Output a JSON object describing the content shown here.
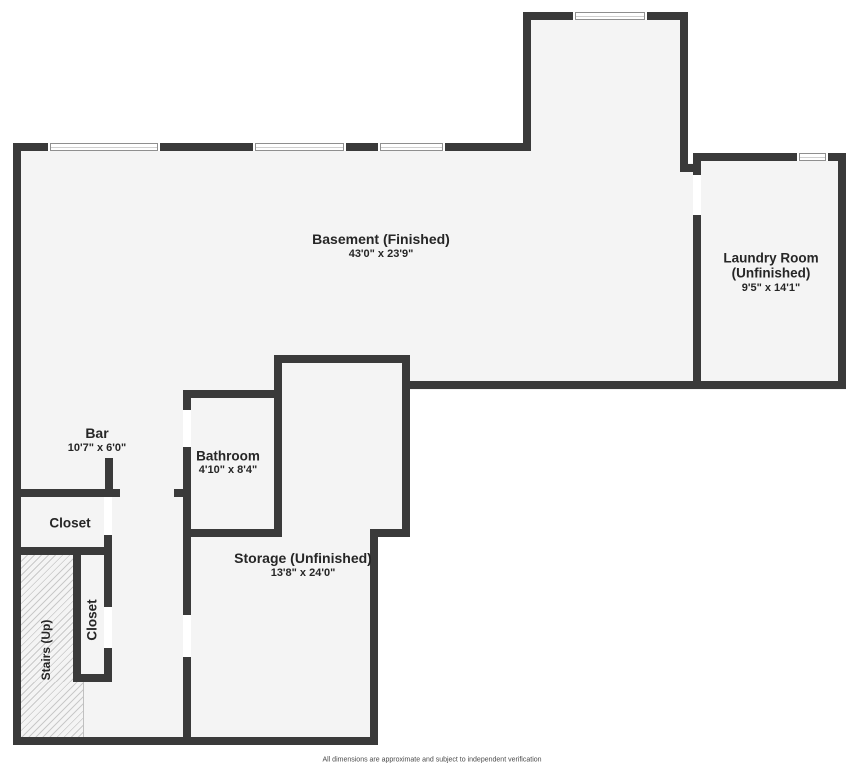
{
  "title": "Basement floor plan",
  "rooms": {
    "basement": {
      "name": "Basement (Finished)",
      "dims": "43'0\" x 23'9\""
    },
    "laundry": {
      "line1": "Laundry Room",
      "line2": "(Unfinished)",
      "dims": "9'5\" x 14'1\""
    },
    "bar": {
      "name": "Bar",
      "dims": "10'7\" x 6'0\""
    },
    "closet_upper": {
      "name": "Closet"
    },
    "bathroom": {
      "name": "Bathroom",
      "dims": "4'10\" x 8'4\""
    },
    "storage": {
      "name": "Storage (Unfinished)",
      "dims": "13'8\" x 24'0\""
    },
    "closet_lower": {
      "name": "Closet"
    },
    "stairs": {
      "name": "Stairs (Up)"
    }
  },
  "footer": {
    "disclaimer": "All dimensions are approximate and subject to independent verification"
  },
  "colors": {
    "wall": "#3a3a3a",
    "floor": "#f4f4f4",
    "background": "#ffffff",
    "hatch_line": "#c9c9c9",
    "text": "#262626"
  }
}
